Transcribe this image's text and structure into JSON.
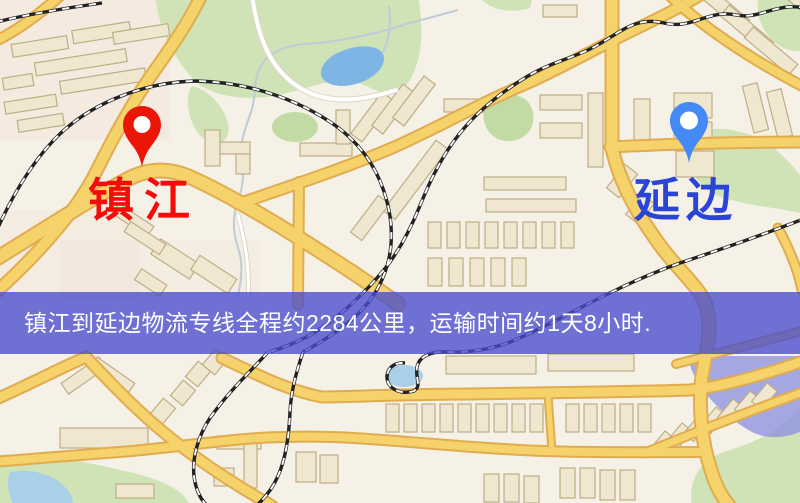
{
  "banner": {
    "text": "镇江到延边物流专线全程约2284公里，运输时间约1天8小时."
  },
  "markers": {
    "origin": {
      "label": "镇江"
    },
    "destination": {
      "label": "延边"
    }
  },
  "palette": {
    "map_bg": "#f5f1e7",
    "road_fill": "#f6d36a",
    "road_casing": "#e0ac50",
    "minor_road": "#ffffff",
    "park_green": "#cfe3b6",
    "park_green_dark": "#c2dba4",
    "water_blue": "#7fb5e4",
    "water_light": "#a9cfe9",
    "building_fill": "#f0e7d1",
    "building_stroke": "#bfae84",
    "railway_dark": "#222222",
    "railway_light": "#ffffff",
    "stream_gray": "#becbd9",
    "district_lavender": "#8a8de2",
    "banner_bg": "rgba(72,76,205,0.78)",
    "banner_text": "#ffffff",
    "label_origin": "#f20d0b",
    "label_destination": "#2b44d8",
    "pin_origin": "#ec1607",
    "pin_destination": "#4589f6"
  }
}
